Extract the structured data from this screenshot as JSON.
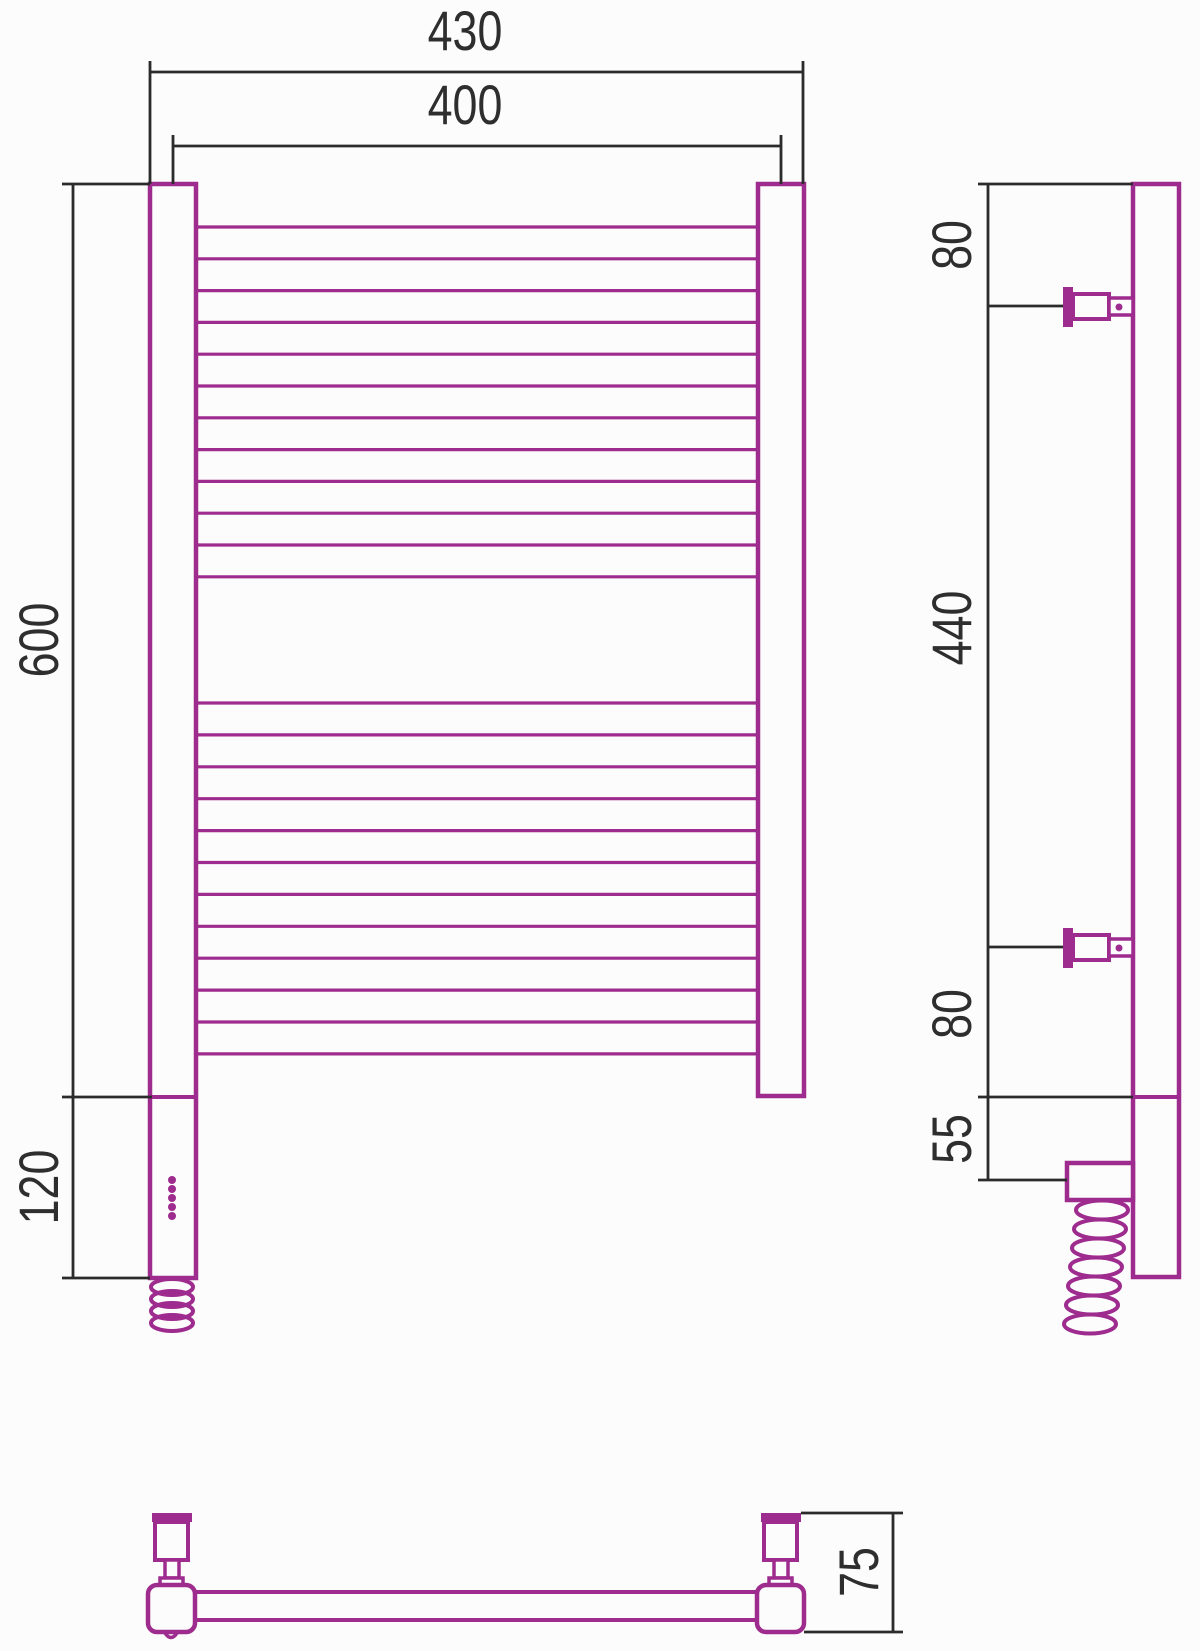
{
  "drawing": {
    "kind": "technical dimension drawing, heated towel rail (ladder style), three orthographic views",
    "colors": {
      "product_outline": "#9e2b8e",
      "dimension_lines": "#2b2b2b",
      "label_text": "#2e2e2e",
      "background": "#fcfcfc"
    }
  },
  "dimensions": {
    "front": {
      "overall_width": "430",
      "pivot_width": "400",
      "height": "600",
      "element_height": "120"
    },
    "side": {
      "top_offset": "80",
      "bracket_span": "440",
      "bottom_offset": "80",
      "element_offset": "55"
    },
    "bottom": {
      "depth": "75"
    }
  },
  "front_view": {
    "rungs": {
      "x1": 196,
      "x2": 758,
      "stroke_width": 3.2,
      "groups": [
        {
          "start_y": 227,
          "spacing": 31.8,
          "count": 12
        },
        {
          "start_y": 703,
          "spacing": 31.9,
          "count": 12
        }
      ]
    },
    "led_dots": {
      "count": 5,
      "cx": 172,
      "start_y": 1180,
      "spacing": 9,
      "radius": 4
    },
    "cable_coil": {
      "cx": 172,
      "start_y": 1287,
      "spacing": 12,
      "count": 4,
      "rx": 21,
      "ry": 8
    }
  },
  "side_view": {
    "cable_coil": {
      "cx": 1102,
      "start_y": 1210,
      "spacing": 19,
      "count": 7,
      "rx": 26,
      "ry": 9.5,
      "drift": -2
    }
  }
}
